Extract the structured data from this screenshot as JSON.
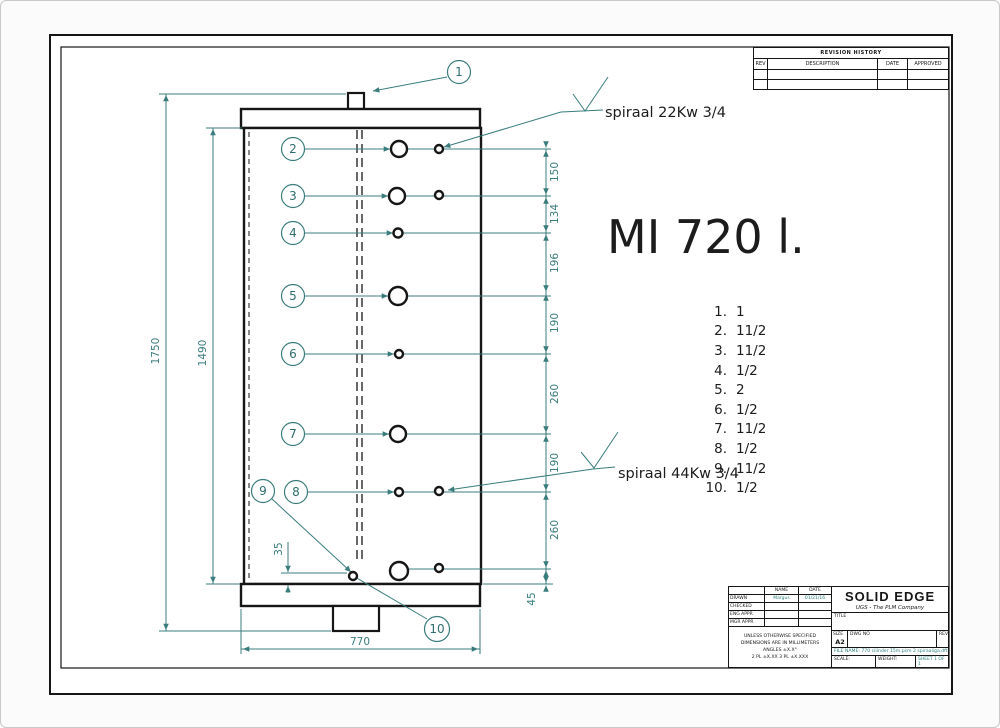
{
  "colors": {
    "accent": "#3a7c7c",
    "line": "#161616"
  },
  "drawing": {
    "product_title": "MI 720 l.",
    "spiral_top_label": "spiraal 22Kw 3/4",
    "spiral_bottom_label": "spiraal 44Kw 3/4"
  },
  "callouts": {
    "c1": "1",
    "c2": "2",
    "c3": "3",
    "c4": "4",
    "c5": "5",
    "c6": "6",
    "c7": "7",
    "c8": "8",
    "c9": "9",
    "c10": "10"
  },
  "connection_list": [
    {
      "index": "1.",
      "size": "1"
    },
    {
      "index": "2.",
      "size": "11/2"
    },
    {
      "index": "3.",
      "size": "11/2"
    },
    {
      "index": "4.",
      "size": "1/2"
    },
    {
      "index": "5.",
      "size": "2"
    },
    {
      "index": "6.",
      "size": "1/2"
    },
    {
      "index": "7.",
      "size": "11/2"
    },
    {
      "index": "8.",
      "size": "1/2"
    },
    {
      "index": "9.",
      "size": "11/2"
    },
    {
      "index": "10.",
      "size": "1/2"
    }
  ],
  "dimensions": {
    "overall_height": "1750",
    "body_height": "1490",
    "bottom_width": "770",
    "drain_offset": "35",
    "right_chain": [
      "150",
      "134",
      "196",
      "190",
      "260",
      "190",
      "260",
      "45"
    ]
  },
  "revision_table": {
    "title": "REVISION HISTORY",
    "columns": [
      "REV",
      "DESCRIPTION",
      "DATE",
      "APPROVED"
    ]
  },
  "title_block": {
    "name_col": "NAME",
    "date_col": "DATE",
    "drawn_label": "DRAWN",
    "drawn_name": "Margus",
    "drawn_date": "01/21/16",
    "checked_label": "CHECKED",
    "engappr_label": "ENG APPR",
    "mgrappr_label": "MGR APPR",
    "tolerance_note_1": "UNLESS OTHERWISE SPECIFIED",
    "tolerance_note_2": "DIMENSIONS ARE IN MILLIMETERS",
    "tolerance_note_3": "ANGLES ±X.X°",
    "tolerance_note_4": "2 PL ±X.XX 3 PL ±X.XXX",
    "logo": "SOLID EDGE",
    "logo_subtitle": "UGS - The PLM Company",
    "title_label": "TITLE",
    "size_label": "SIZE",
    "size_value": "A2",
    "dwg_no_label": "DWG NO",
    "rev_label": "REV",
    "file_name": "FILE NAME: 770 cilinder 15m.psm 2 spiraaliga.dft",
    "scale_label": "SCALE:",
    "weight_label": "WEIGHT:",
    "sheet_label": "SHEET 1 OF 1"
  }
}
